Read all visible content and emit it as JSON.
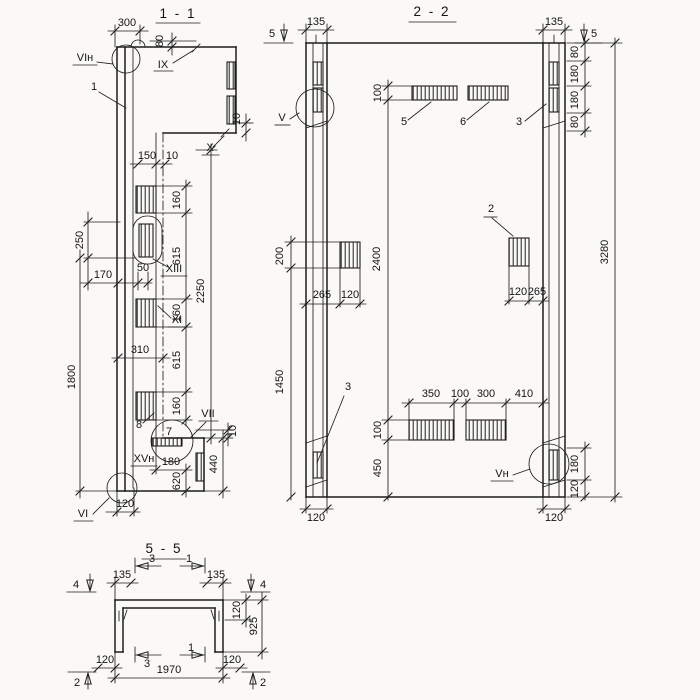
{
  "palette": {
    "paper": "#faf9f6",
    "ink": "#1e1e1e"
  },
  "s11": {
    "title": "1 - 1",
    "dims": {
      "d300": "300",
      "d80": "80",
      "d10_step": "10",
      "d150": "150",
      "d10_gap": "10",
      "r160a": "160",
      "r615a": "615",
      "r160b": "160",
      "r615b": "615",
      "r160c": "160",
      "d2250": "2250",
      "d250": "250",
      "d170": "170",
      "d50": "50",
      "d1800": "1800",
      "d310": "310",
      "d10_heel": "10",
      "d180": "180",
      "d620": "620",
      "d440": "440",
      "d120": "120"
    },
    "marks": {
      "vi_top": "VIн",
      "pos1": "1",
      "ix": "IX",
      "x": "X",
      "xiii": "XIII",
      "xi": "XI",
      "pos8": "8",
      "pos7": "7",
      "vii": "VII",
      "xv": "XVн",
      "vi_bottom": "VI"
    }
  },
  "s22": {
    "title": "2 - 2",
    "dims": {
      "d135_left": "135",
      "d135_right": "135",
      "d80_1": "80",
      "d180_1": "180",
      "d180_2": "180",
      "d80_2": "80",
      "d100_top": "100",
      "d2400": "2400",
      "d100_bot": "100",
      "d450": "450",
      "d200": "200",
      "d1450": "1450",
      "d265_left": "265",
      "d120_left": "120",
      "d120_mid": "120",
      "d265_mid": "265",
      "d350": "350",
      "d100_row": "100",
      "d300": "300",
      "d410": "410",
      "d3280": "3280",
      "d180_br": "180",
      "d120_br": "120",
      "d120_bl": "120",
      "d120_bc": "120"
    },
    "marks": {
      "cut5_left": "5",
      "cut5_right": "5",
      "v": "V",
      "v_bottom": "Vн",
      "pos5": "5",
      "pos6": "6",
      "pos3_top": "3",
      "pos3_bottom": "3",
      "pos2": "2"
    }
  },
  "s55": {
    "title": "5 - 5",
    "dims": {
      "d135_left": "135",
      "d135_right": "135",
      "d120_flange": "120",
      "d925": "925",
      "d120_bl": "120",
      "d120_br": "120",
      "d1970": "1970"
    },
    "marks": {
      "cut4_left": "4",
      "cut4_right": "4",
      "cut3_top": "3",
      "cut1_top": "1",
      "cut3_bottom": "3",
      "cut1_bottom": "1",
      "cut2_left": "2",
      "cut2_right": "2"
    }
  }
}
